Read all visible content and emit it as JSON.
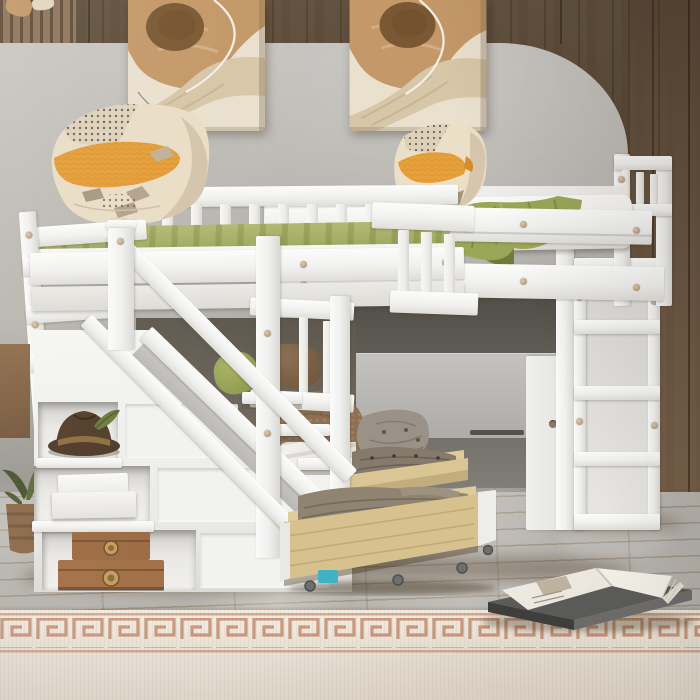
{
  "meta": {
    "description": "Product photograph of a white wooden twin-over-twin bunk bed with storage staircase, attached side loft bed, cube ladder shelf and two rolling birch under-bed storage drawers, staged in a bedroom with abstract wall art, oak floor and a greek-key rug"
  },
  "labels": {
    "scene": "staged bedroom product photo of white bunk bed system",
    "wood_wall": "dark walnut plank accent wall",
    "slat_panel": "light wood slat accent in upper left corner",
    "gray_wall": "warm gray painted wall panel with rounded arch corner",
    "artwork_left": "abstract painting in tan, brown and cream",
    "artwork_right": "abstract painting in tan, brown and cream",
    "left_bunk": "upper twin bunk with green fitted sheet",
    "left_pillow": "cream, orange and taupe knit throw pillow",
    "loft_bed": "side loft bed with white mattress",
    "loft_pillow": "cream, orange and taupe knit throw pillow",
    "green_blanket": "olive green throw blanket",
    "back_guardrail": "white slatted guardrail",
    "front_guardrail": "white slatted guardrail",
    "loft_guardrail": "white loft guardrail",
    "loft_headboard": "white slatted loft headboard",
    "staircase": "white storage staircase with handrail",
    "handrail": "diagonal white stair handrail",
    "cubby_hat": "brown fedora hat with olive feather",
    "cubby_boxes": "stack of white storage boxes",
    "cubby_chests": "two vintage wooden chests with brass medallions",
    "lower_bed": "lower twin bed with textured brown blanket",
    "green_pillow": "olive green pillow",
    "brown_pillow": "brown pillow",
    "drawer_rear": "rolling birch storage drawer with folded gray clothes",
    "drawer_front": "rolling birch storage drawer with folded taupe blanket",
    "drawer_pillow": "gray tufted cushion",
    "underbed_drawer": "walnut under-bed drawer",
    "shelf_ladder": "white four-cube ladder shelf",
    "cabinet_door": "white cabinet door with round finger pull",
    "nightstand": "walnut nightstand edge",
    "plant": "potted plant in woven basket",
    "toy": "small teal block",
    "floor": "light oak plank floor",
    "rug": "cream rug with terracotta greek key border",
    "book": "open white book resting on a dark closed book"
  },
  "palette": {
    "wood_wall": "#55463a",
    "wood_wall_right": "#65513e",
    "slat_wood": "#8d745c",
    "gray_wall": "#b7b4af",
    "gray_wall_light": "#c6c3be",
    "frame_white": "#f4f4f2",
    "frame_shadow": "#dddcd8",
    "floor_oak": "#d2a566",
    "rug_cream": "#eae3d8",
    "rug_terracotta": "#c18467",
    "sheet_green": "#a7af66",
    "blanket_green": "#9aa757",
    "pillow_orange": "#e69d36",
    "pillow_cream": "#e9ddc6",
    "pillow_taupe": "#a8977f",
    "blanket_brown": "#8e7052",
    "mattress_white": "#f3f1ee",
    "hat_brown": "#503b28",
    "chest_wood": "#9c6b42",
    "drawer_birch": "#d6c18f",
    "clothes_gray": "#857a6b",
    "clothes_taupe": "#8f8372",
    "cushion_gray": "#9b9287",
    "painting_tan": "#c49868",
    "painting_brown": "#7a5833",
    "painting_cream": "#e9e0ce",
    "painting_beige": "#d7c6a7",
    "book_cover": "#5c5c5a",
    "under_loft_shadow": "#57534d",
    "plant_green": "#4a5731",
    "toy_teal": "#3fb3c3"
  }
}
